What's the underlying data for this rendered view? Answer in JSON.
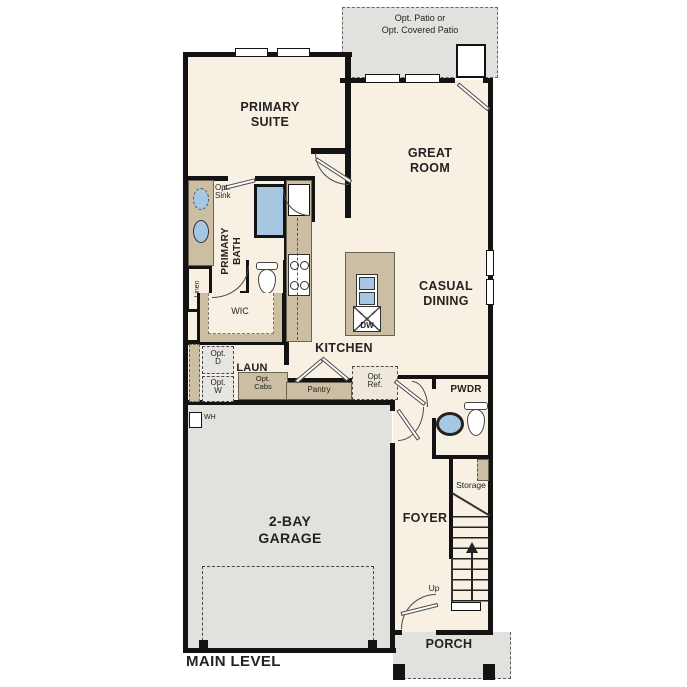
{
  "labels": {
    "patio": "Opt. Patio or\nOpt. Covered Patio",
    "primary_suite": "PRIMARY\nSUITE",
    "great_room": "GREAT\nROOM",
    "casual_dining": "CASUAL\nDINING",
    "kitchen": "KITCHEN",
    "opt_sink": "Opt.\nSink",
    "primary_bath": "PRIMARY\nBATH",
    "linen": "Linen",
    "wic": "WIC",
    "opt_d": "Opt.\nD",
    "opt_w": "Opt.\nW",
    "laundry": "LAUN",
    "opt_cabs": "Opt.\nCabs",
    "pantry": "Pantry",
    "dishwasher": "DW",
    "opt_ref": "Opt.\nRef.",
    "powder": "PWDR",
    "storage": "Storage",
    "foyer": "FOYER",
    "stairs_up": "Up",
    "water_heater": "WH",
    "garage": "2-BAY\nGARAGE",
    "porch": "PORCH",
    "main_level": "MAIN LEVEL"
  },
  "colors": {
    "floor": "#f8f0e2",
    "outdoor": "#e2e1dd",
    "cabinet": "#cbbea2",
    "fixture": "#a6c7e2",
    "wall": "#131313",
    "text": "#232323"
  }
}
